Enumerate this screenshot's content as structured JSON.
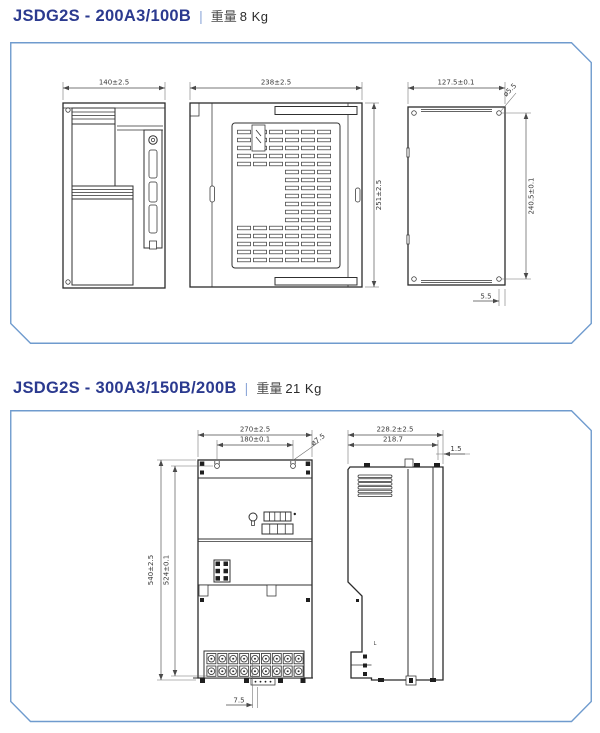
{
  "page": {
    "background": "#ffffff",
    "panel_border_color": "#6f9bce",
    "drawing_line_color": "#303030",
    "title_color": "#2b3a8f"
  },
  "sections": [
    {
      "id": "jsdg2s-200",
      "model": "JSDG2S - 200A3/100B",
      "separator": "|",
      "weight_label": "重量",
      "weight_value": "8 Kg",
      "dims": {
        "front_width": "140±2.5",
        "top_width": "238±2.5",
        "top_height": "251±2.5",
        "plate_width": "127.5±0.1",
        "plate_hole": "ø5.5",
        "plate_height": "240.5±0.1",
        "plate_edge": "5.5"
      }
    },
    {
      "id": "jsdg2s-300",
      "model": "JSDG2S - 300A3/150B/200B",
      "separator": "|",
      "weight_label": "重量",
      "weight_value": "21 Kg",
      "dims": {
        "front_width": "270±2.5",
        "hole_span": "180±0.1",
        "front_hole": "ø7.5",
        "front_height": "540±2.5",
        "hole_height": "524±0.1",
        "bottom_edge": "7.5",
        "side_depth": "228.2±2.5",
        "side_inner_depth": "218.7",
        "side_lip": "1.5",
        "side_mark": "L"
      }
    }
  ]
}
